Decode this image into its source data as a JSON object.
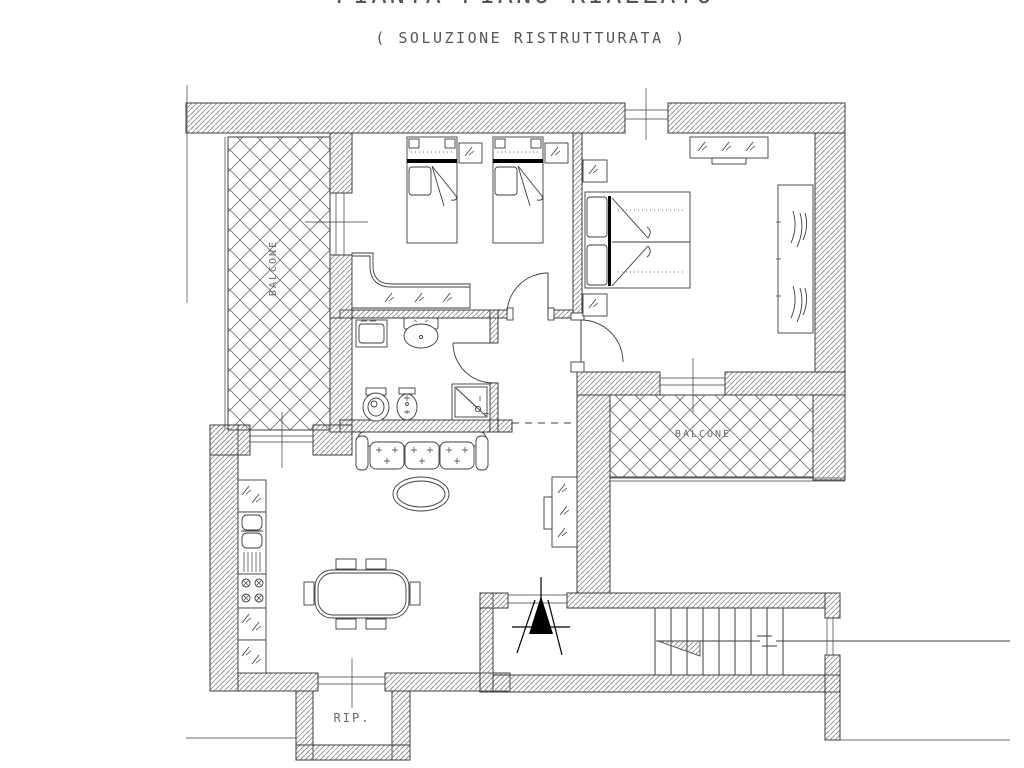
{
  "page": {
    "title": "PIANTA PIANO RIALZATO",
    "subtitle": "( SOLUZIONE RISTRUTTURATA )"
  },
  "plan": {
    "labels": {
      "balcony_left": "BALCONE",
      "balcony_right": "BALCONE",
      "storage": "RIP."
    },
    "furniture_symbols": [
      "single-bed",
      "nightstand",
      "desk",
      "double-bed",
      "dresser",
      "wardrobe",
      "washing-machine",
      "washbasin",
      "toilet",
      "bidet",
      "shower",
      "sofa",
      "coffee-table",
      "dining-table",
      "dining-chair",
      "sideboard",
      "tv",
      "kitchen-cabinet",
      "kitchen-sink",
      "stove",
      "stairs",
      "entrance-arrow",
      "door-swing",
      "window"
    ]
  },
  "colors": {
    "line": "#3c3c3c",
    "hatch": "#8e8e8e",
    "lattice": "#6f6f6f",
    "text": "#6b6b6b",
    "accent": "#000000",
    "bg": "#ffffff"
  }
}
